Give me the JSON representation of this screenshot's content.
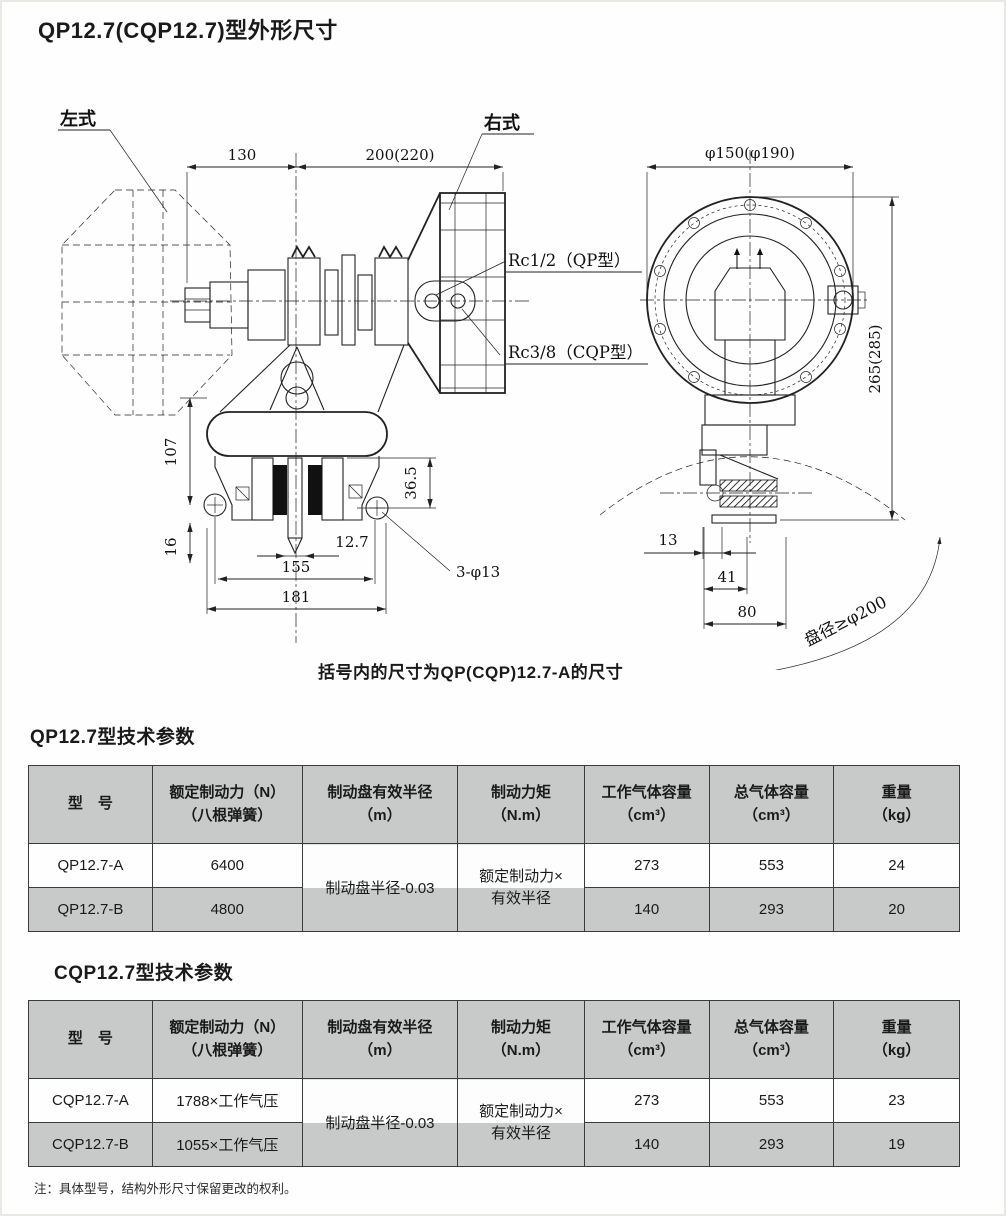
{
  "page": {
    "title": "QP12.7(CQP12.7)型外形尺寸",
    "caption": "括号内的尺寸为QP(CQP)12.7-A的尺寸",
    "footnote": "注：具体型号，结构外形尺寸保留更改的权利。"
  },
  "drawing": {
    "labels": {
      "left_type": "左式",
      "right_type": "右式",
      "rc_qp": "Rc1/2（QP型）",
      "rc_cqp": "Rc3/8（CQP型）",
      "disc_dia": "盘径≥φ200"
    },
    "dims": {
      "w130": "130",
      "w200": "200(220)",
      "dia150": "φ150(φ190)",
      "h265": "265(285)",
      "h107": "107",
      "h36_5": "36.5",
      "h16": "16",
      "t12_7": "12.7",
      "w155": "155",
      "w181": "181",
      "holes": "3-φ13",
      "w13": "13",
      "w41": "41",
      "w80": "80"
    }
  },
  "tables": [
    {
      "title": "QP12.7型技术参数",
      "headers": [
        {
          "l1": "型　号",
          "l2": ""
        },
        {
          "l1": "额定制动力（N）",
          "l2": "（八根弹簧）"
        },
        {
          "l1": "制动盘有效半径",
          "l2": "（m）"
        },
        {
          "l1": "制动力矩",
          "l2": "（N.m）"
        },
        {
          "l1": "工作气体容量",
          "l2": "（cm³）"
        },
        {
          "l1": "总气体容量",
          "l2": "（cm³）"
        },
        {
          "l1": "重量",
          "l2": "（kg）"
        }
      ],
      "merged": {
        "radius": "制动盘半径-0.03",
        "torque_l1": "额定制动力×",
        "torque_l2": "有效半径"
      },
      "rows": [
        {
          "model": "QP12.7-A",
          "force": "6400",
          "work_vol": "273",
          "total_vol": "553",
          "weight": "24"
        },
        {
          "model": "QP12.7-B",
          "force": "4800",
          "work_vol": "140",
          "total_vol": "293",
          "weight": "20"
        }
      ]
    },
    {
      "title": "CQP12.7型技术参数",
      "headers": [
        {
          "l1": "型　号",
          "l2": ""
        },
        {
          "l1": "额定制动力（N）",
          "l2": "（八根弹簧）"
        },
        {
          "l1": "制动盘有效半径",
          "l2": "（m）"
        },
        {
          "l1": "制动力矩",
          "l2": "（N.m）"
        },
        {
          "l1": "工作气体容量",
          "l2": "（cm³）"
        },
        {
          "l1": "总气体容量",
          "l2": "（cm³）"
        },
        {
          "l1": "重量",
          "l2": "（kg）"
        }
      ],
      "merged": {
        "radius": "制动盘半径-0.03",
        "torque_l1": "额定制动力×",
        "torque_l2": "有效半径"
      },
      "rows": [
        {
          "model": "CQP12.7-A",
          "force": "1788×工作气压",
          "work_vol": "273",
          "total_vol": "553",
          "weight": "23"
        },
        {
          "model": "CQP12.7-B",
          "force": "1055×工作气压",
          "work_vol": "140",
          "total_vol": "293",
          "weight": "19"
        }
      ]
    }
  ]
}
